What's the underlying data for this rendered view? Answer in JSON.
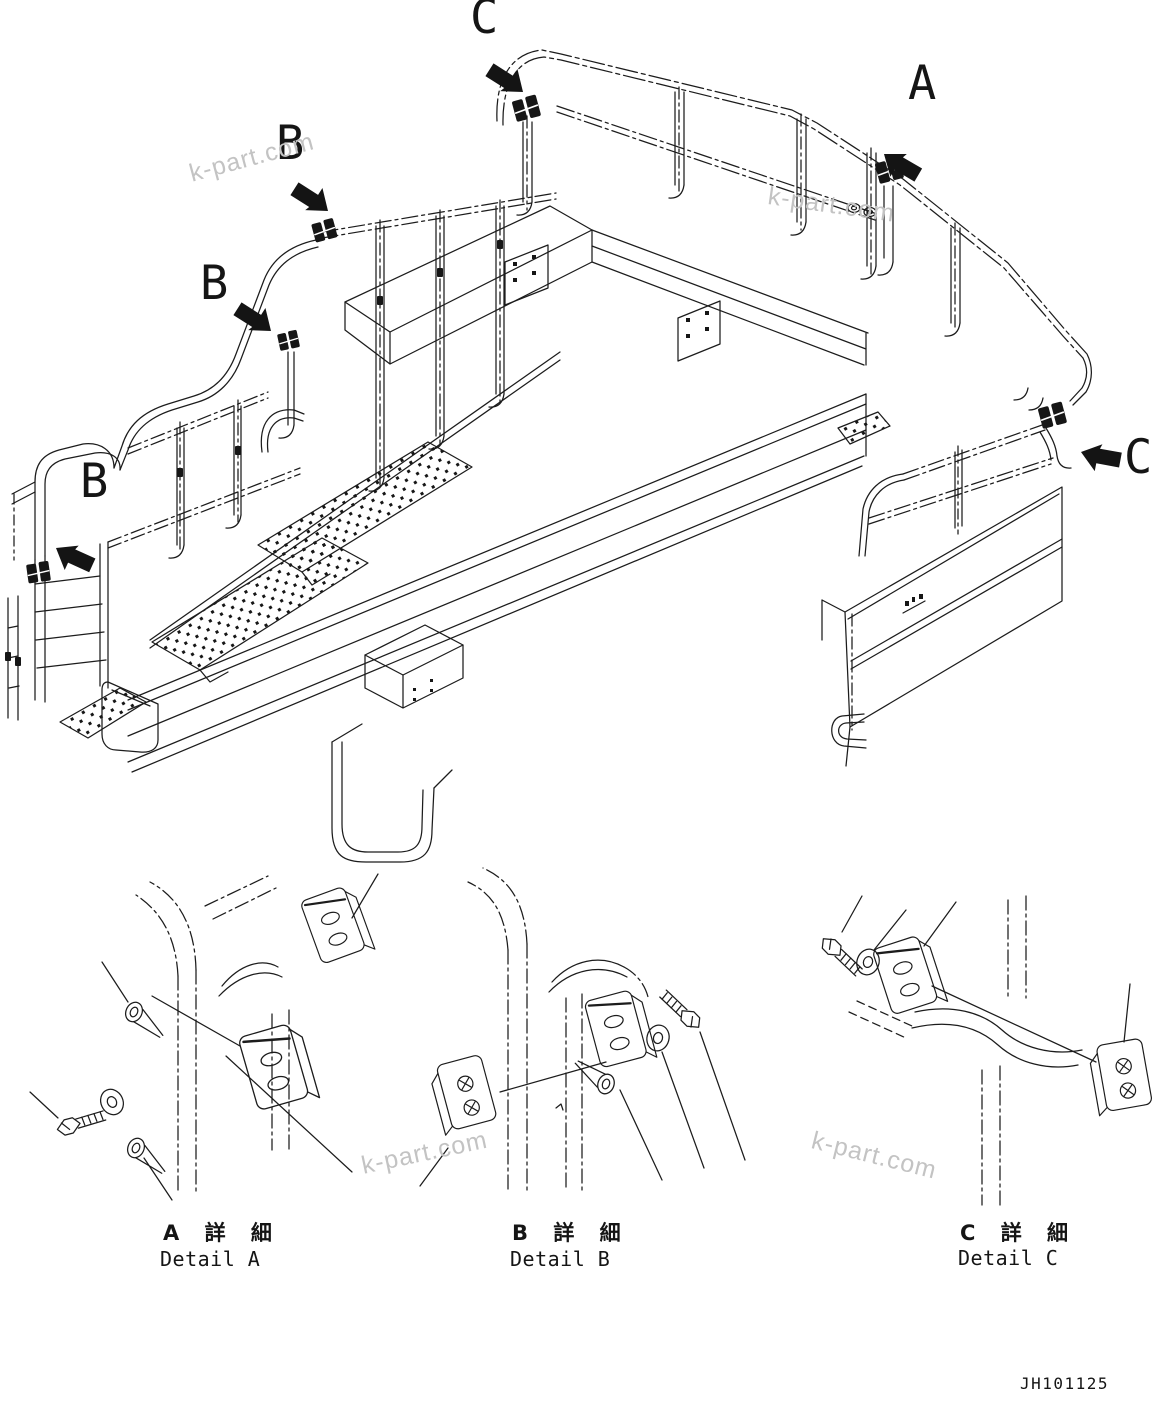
{
  "figure": {
    "type": "parts-diagram",
    "drawing_number": "JH101125",
    "watermark": "k-part.com",
    "callouts": {
      "c_top": "C",
      "a": "A",
      "b_upper": "B",
      "b_mid": "B",
      "b_lower": "B",
      "c_right": "C"
    },
    "details": {
      "a": {
        "jp": "A 詳 細",
        "en": "Detail A"
      },
      "b": {
        "jp": "B 詳 細",
        "en": "Detail B"
      },
      "c": {
        "jp": "C 詳 細",
        "en": "Detail C"
      }
    },
    "colors": {
      "line": "#1c1c1c",
      "background": "#ffffff",
      "watermark": "#c3c3c3",
      "arrow": "#141414"
    }
  }
}
